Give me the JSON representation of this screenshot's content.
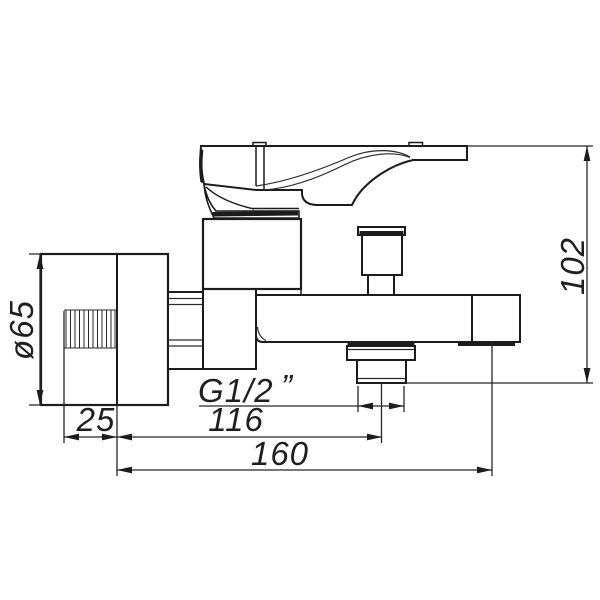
{
  "drawing": {
    "title": "Wall-mounted bath mixer faucet - side view technical drawing",
    "background_color": "#ffffff",
    "line_color": "#1c1c1c",
    "dimensions": {
      "flange_diameter": {
        "label": "ø65",
        "orientation": "vertical",
        "measures": "wall escutcheon diameter"
      },
      "total_height": {
        "label": "102",
        "orientation": "vertical",
        "measures": "overall height"
      },
      "flange_depth": {
        "label": "25",
        "orientation": "horizontal",
        "measures": "escutcheon depth"
      },
      "outlet_offset": {
        "label": "116",
        "orientation": "horizontal",
        "measures": "wall to shower outlet centre"
      },
      "total_reach": {
        "label": "160",
        "orientation": "horizontal",
        "measures": "wall to spout end"
      },
      "thread": {
        "label": "G1/2",
        "unit_mark": "”",
        "measures": "outlet thread size"
      }
    }
  }
}
